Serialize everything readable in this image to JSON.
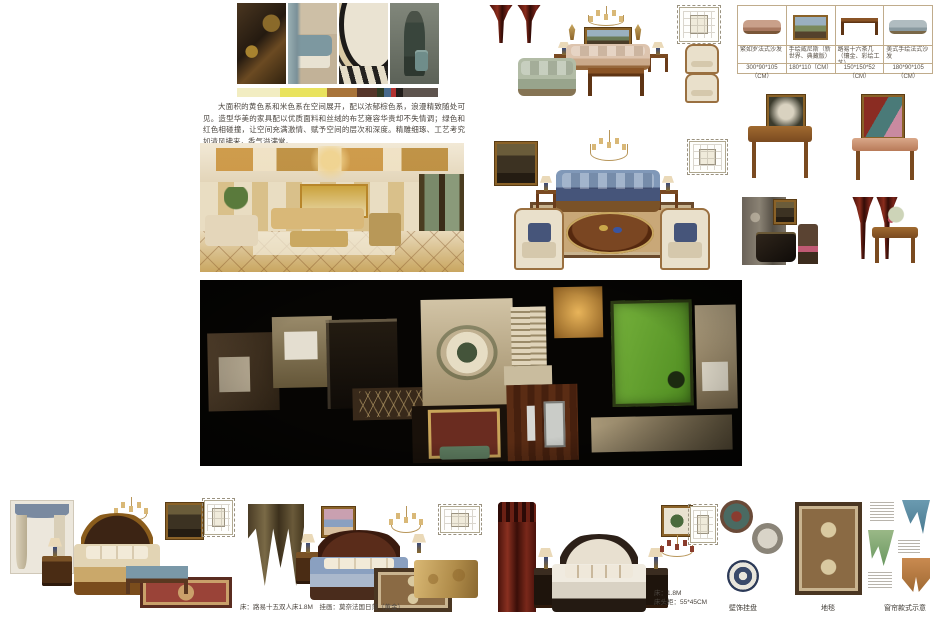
{
  "intro": {
    "paragraph": "大面积的黄色系和米色系在空间展开，配以浓郁棕色系，浪漫精致随处可见。造型华美的家具配以优质面料和丝绒的布艺雍容华贵却不失情调；绿色和红色相碰撞，让空间充满激情、赋予空间的层次和深度。精雕细琢、工艺考究如清风拂来，香气溢满堂。"
  },
  "palette": {
    "colors": [
      {
        "c": "#f2edc2",
        "w": 25
      },
      {
        "c": "#e9e35e",
        "w": 27
      },
      {
        "c": "#a8743a",
        "w": 17
      },
      {
        "c": "#56362a",
        "w": 12
      },
      {
        "c": "#2e3b24",
        "w": 4
      },
      {
        "c": "#47698c",
        "w": 4
      },
      {
        "c": "#b23230",
        "w": 3
      },
      {
        "c": "#221d1a",
        "w": 4
      },
      {
        "c": "#5e544e",
        "w": 20
      }
    ]
  },
  "catalog": {
    "items": [
      {
        "name": "繁如罗法式沙发",
        "size": "300*90*105（CM）"
      },
      {
        "name": "手绘威尼斯（新世界、典藏版）",
        "size": "180*110（CM）"
      },
      {
        "name": "路易十六茶几（镶金、彩绘工艺）",
        "size": "150*150*52（CM）"
      },
      {
        "name": "美式手绘法式沙发",
        "size": "180*90*105（CM）"
      }
    ]
  },
  "bottom": {
    "set2_caption": "床：路易十五双人床1.8M　挂画：莫奈法国日落（黄金）",
    "set3_caption_bed": "床：1.8M",
    "set3_caption_nightstand": "床头柜：55*45CM",
    "label_plates": "壁饰挂盘",
    "label_rug": "地毯",
    "label_curtain": "窗帘款式示意"
  }
}
